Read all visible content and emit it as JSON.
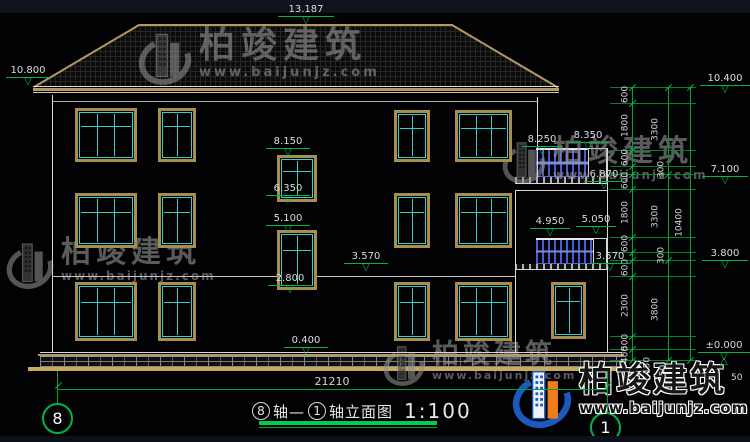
{
  "drawing": {
    "title_full": "⑧轴—①轴立面图 1:100",
    "title": {
      "axis_from": "8",
      "joiner": "轴—",
      "axis_to": "1",
      "suffix": "轴立面图",
      "scale": "1:100"
    },
    "axis_bubbles": {
      "left": "8",
      "right": "1"
    },
    "elevations": {
      "ridge": "13.187",
      "left_eave": "10.800",
      "stair": [
        "8.150",
        "6.350",
        "5.100",
        "2.800"
      ],
      "floor2_left": "3.570",
      "plinth": "0.400",
      "upper_balcony": [
        "8.250",
        "8.350",
        "6.870"
      ],
      "lower_balcony": [
        "4.950",
        "5.050",
        "3.570"
      ],
      "right": [
        "10.400",
        "7.100",
        "3.800",
        "±0.000"
      ]
    },
    "dimensions": {
      "total_width": "21210",
      "total_height": "10400",
      "floor_heights": [
        "3300",
        "3300",
        "3800"
      ],
      "segments": [
        "600",
        "1800",
        "600",
        "300",
        "600",
        "1800",
        "600",
        "300",
        "600",
        "2300",
        "500",
        "400"
      ],
      "base_segments": [
        "150",
        "50",
        "50"
      ]
    }
  },
  "watermark": {
    "brand": "柏竣建筑",
    "url": "www.baijunjz.com"
  },
  "icons": {
    "elevation_triangle_down": "▽",
    "elevation_triangle_up": "△"
  },
  "colors": {
    "dim_green": "#00b44c",
    "line_white": "#e2e2e2",
    "frame_tan": "#a68e4e",
    "sash_cyan": "#39cfcf",
    "railing_blue": "#4a5cd0",
    "ground_tan": "#c9a95f",
    "logo_blue": "#1b59bb",
    "logo_orange": "#ef7d1a",
    "wm_gray": "#909090"
  }
}
